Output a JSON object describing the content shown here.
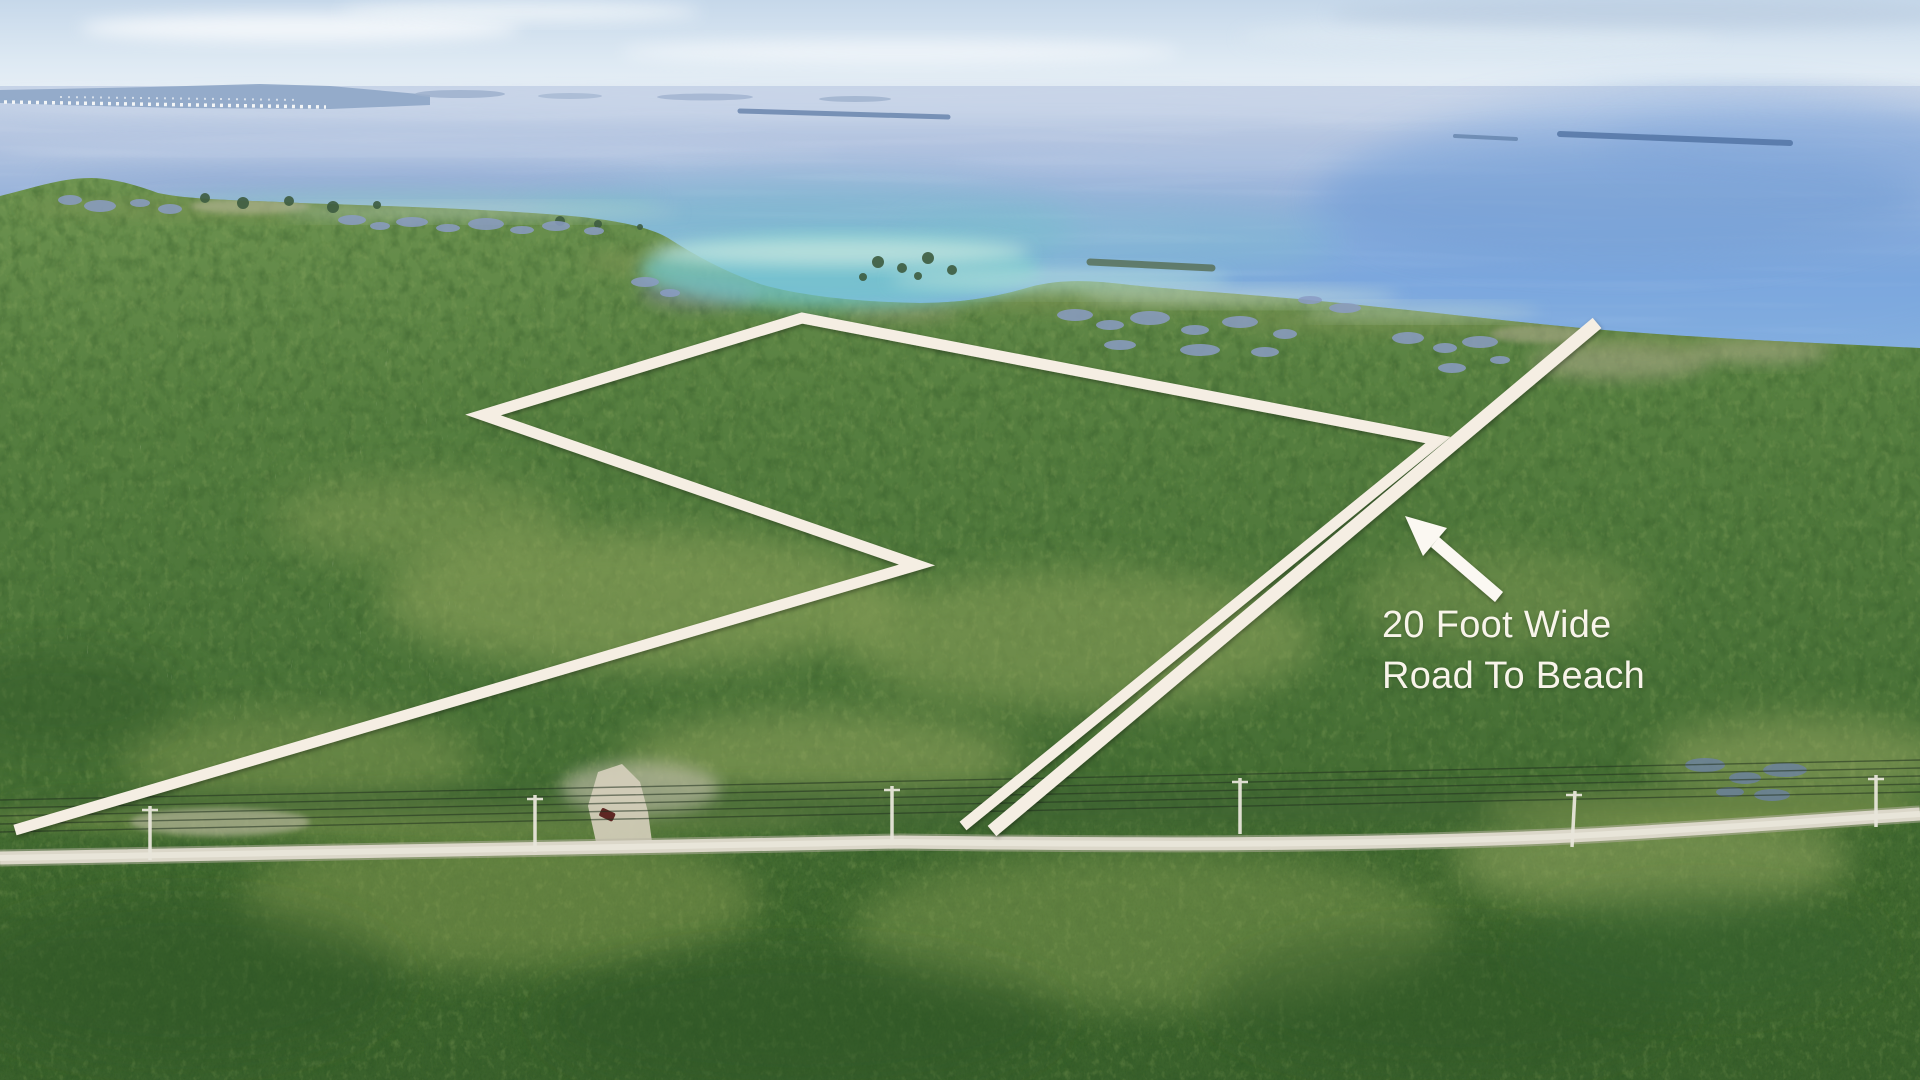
{
  "annotation": {
    "line1": "20 Foot Wide",
    "line2": "Road To Beach"
  },
  "palette": {
    "overlay_white": "#f5eee3",
    "annotation_text": "#f8f4ea",
    "water_blue": "#7fa8dc",
    "shallow_teal": "#7cc8cc",
    "vegetation_green": "#50793d",
    "road_gray": "#dbd7c9",
    "sky_blue": "#d6e4f0"
  }
}
